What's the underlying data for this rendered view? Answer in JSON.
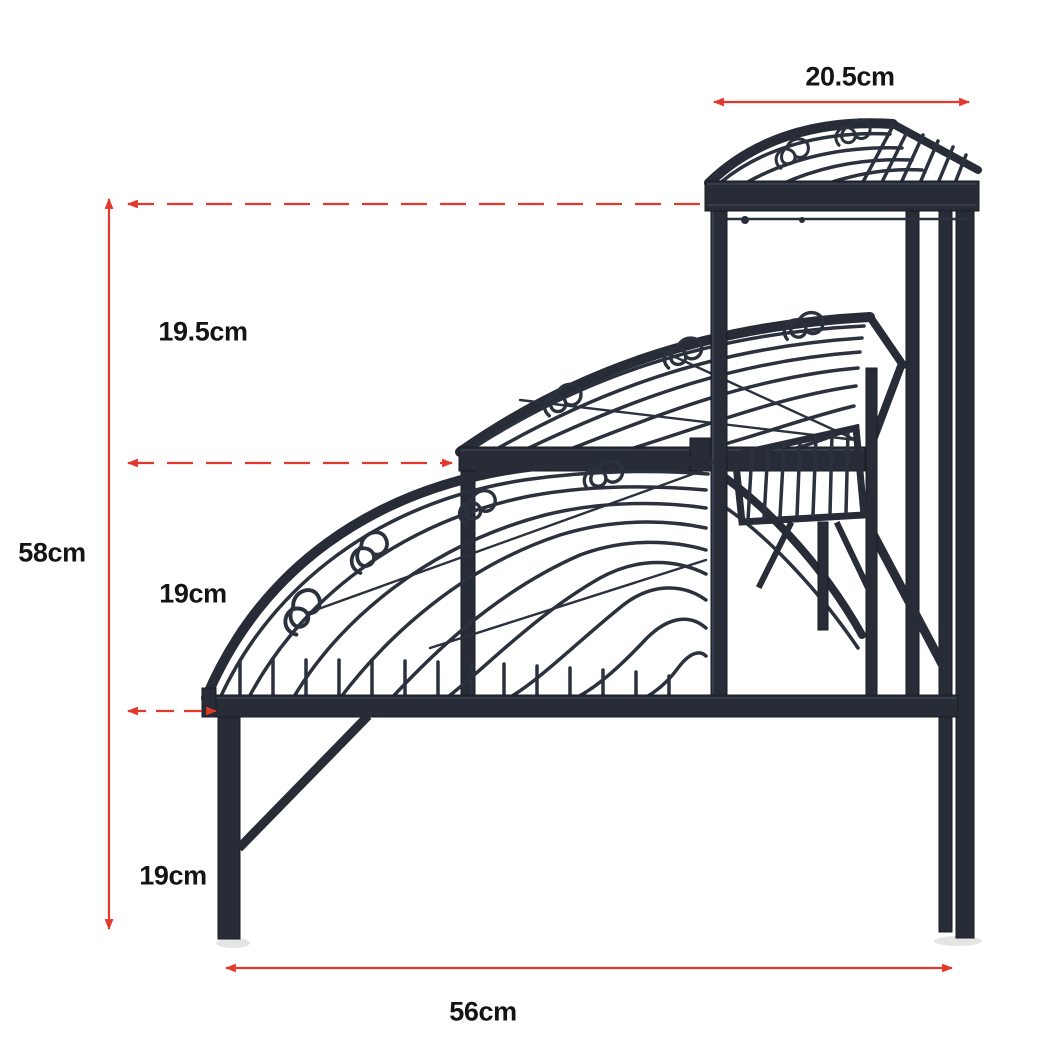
{
  "diagram": {
    "subject": "3-tier fan-shaped corner plant stand, black metal, dimension diagram",
    "background": "#ffffff",
    "metal_color": "#272c37",
    "annotation_color": "#e2382d",
    "label_color": "#141414"
  },
  "dimensions": {
    "top_shelf_width": "20.5cm",
    "top_tier_height": "19.5cm",
    "overall_height": "58cm",
    "middle_tier_height": "19cm",
    "bottom_tier_height": "19cm",
    "base_width": "56cm"
  }
}
